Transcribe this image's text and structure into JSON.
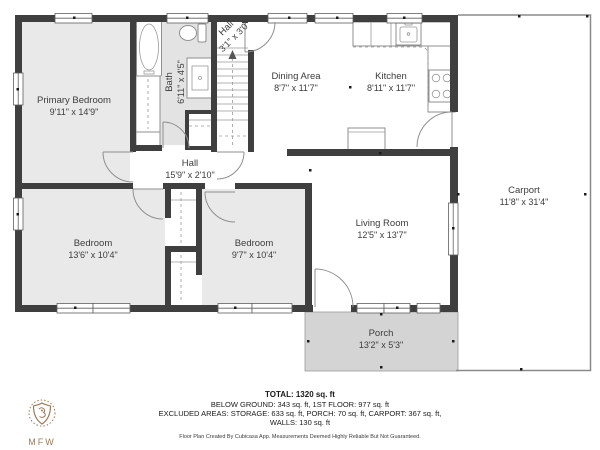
{
  "colors": {
    "wall-color": "#3f3f3f",
    "room-fill": "#e9e9e9",
    "bath-fill": "#e3e3e3",
    "porch-fill": "#d4d4d4",
    "logo-color": "#9b7b5c",
    "label-color": "#3c3c3c"
  },
  "rooms": {
    "primary_bedroom": {
      "name": "Primary Bedroom",
      "dims": "9'11\" x 14'9\""
    },
    "bath": {
      "name": "Bath",
      "dims": "6'11\" x 4'5\""
    },
    "hall_upper": {
      "name": "Hall",
      "dims": "3'1\" x 3'0\""
    },
    "dining_area": {
      "name": "Dining Area",
      "dims": "8'7\" x 11'7\""
    },
    "kitchen": {
      "name": "Kitchen",
      "dims": "8'11\" x 11'7\""
    },
    "carport": {
      "name": "Carport",
      "dims": "11'8\" x 31'4\""
    },
    "hall": {
      "name": "Hall",
      "dims": "15'9\" x 2'10\""
    },
    "living_room": {
      "name": "Living Room",
      "dims": "12'5\" x 13'7\""
    },
    "bedroom_left": {
      "name": "Bedroom",
      "dims": "13'6\" x 10'4\""
    },
    "bedroom_right": {
      "name": "Bedroom",
      "dims": "9'7\" x 10'4\""
    },
    "porch": {
      "name": "Porch",
      "dims": "13'2\" x 5'3\""
    }
  },
  "summary": {
    "total": "TOTAL: 1320 sq. ft",
    "below_ground_line": "BELOW GROUND: 343 sq. ft, 1ST FLOOR: 977 sq. ft",
    "excluded_line": "EXCLUDED AREAS: STORAGE: 633 sq. ft, PORCH: 70 sq. ft, CARPORT: 367 sq. ft,",
    "walls_line": "WALLS: 130 sq. ft",
    "disclaimer": "Floor Plan Created By Cubicasa App. Measurements Deemed Highly Reliable But Not Guaranteed."
  },
  "logo": {
    "text": "MFW"
  }
}
